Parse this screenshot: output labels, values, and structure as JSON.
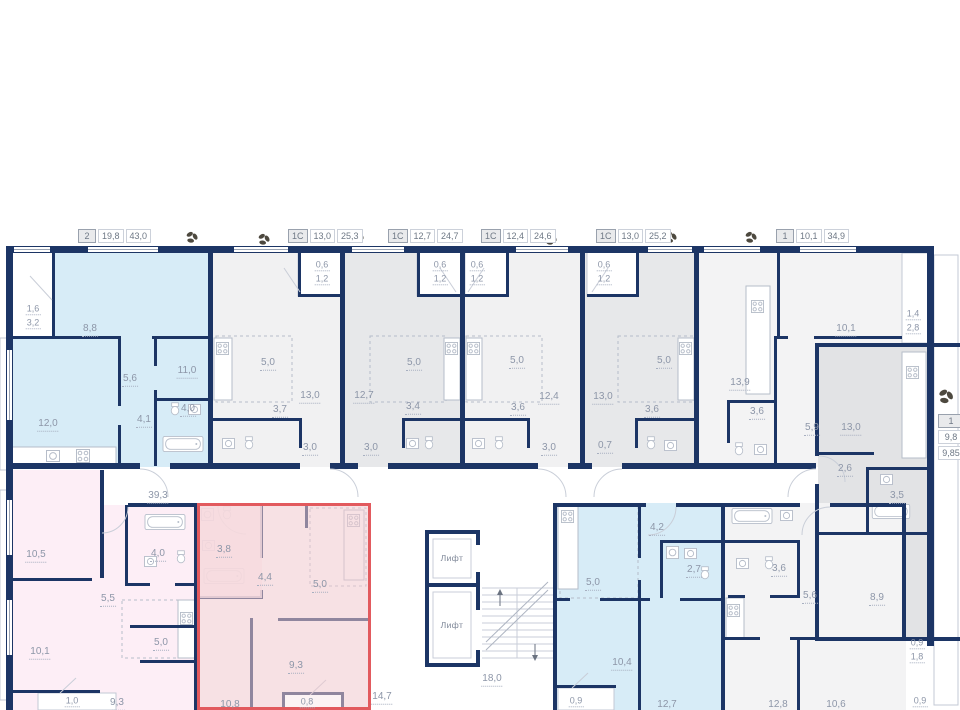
{
  "header": {
    "units": [
      {
        "type": "2",
        "kitchen_area": "19,8",
        "total_area": "43,0"
      },
      {
        "type": "1С",
        "kitchen_area": "13,0",
        "total_area": "25,3"
      },
      {
        "type": "1С",
        "kitchen_area": "12,7",
        "total_area": "24,7"
      },
      {
        "type": "1С",
        "kitchen_area": "12,4",
        "total_area": "24,6"
      },
      {
        "type": "1С",
        "kitchen_area": "13,0",
        "total_area": "25,2"
      },
      {
        "type": "1",
        "kitchen_area": "10,1",
        "total_area": "34,9"
      }
    ]
  },
  "side_label": {
    "type": "1",
    "kitchen_area": "9,8",
    "total_area": "9,85"
  },
  "elevators": {
    "label": "Лифт"
  },
  "areas": {
    "corridor": "39,3",
    "stair_hall": "18,0",
    "lift_lobby": "14,7",
    "apt_2room": {
      "balcony_reduced": "1,6",
      "balcony": "3,2",
      "bedroom": "8,8",
      "hall": "5,6",
      "room": "11,0",
      "bathroom": "4,0",
      "entry": "4,1",
      "living_kitchen": "12,0"
    },
    "studio_1": {
      "balcony_reduced": "0,6",
      "balcony": "1,2",
      "kitchen_zone": "5,0",
      "living": "13,0",
      "bathroom": "3,7",
      "entry": "3,0"
    },
    "studio_2": {
      "balcony_reduced": "0,6",
      "balcony": "1,2",
      "kitchen_zone": "5,0",
      "living": "12,7",
      "bathroom": "3,4",
      "entry": "3,0"
    },
    "studio_3": {
      "balcony_reduced": "0,6",
      "balcony": "1,2",
      "kitchen_zone": "5,0",
      "living": "12,4",
      "bathroom": "3,6",
      "entry": "3,0"
    },
    "studio_4": {
      "balcony_reduced": "0,6",
      "balcony": "1,2",
      "kitchen_zone": "5,0",
      "living": "13,0",
      "bathroom": "3,6",
      "entry": "0,7"
    },
    "apt_1room_top": {
      "living_kitchen": "13,9",
      "bathroom": "3,6",
      "room": "10,1",
      "balcony_reduced": "1,4",
      "balcony": "2,8",
      "hall": "5,9"
    },
    "apt_1room_right": {
      "living_kitchen": "13,0",
      "hall": "2,6",
      "bathroom": "3,5",
      "room": "8,9",
      "balcony_reduced": "0,9",
      "balcony": "1,8"
    },
    "apt_pink": {
      "room_1": "10,5",
      "room_2": "10,1",
      "hall": "5,5",
      "bathroom": "4,0",
      "kitchen_zone": "5,0",
      "room_3": "9,3",
      "balcony": "1,0"
    },
    "apt_selected": {
      "bathroom": "3,8",
      "hall": "4,4",
      "kitchen_zone": "5,0",
      "room_1": "9,3",
      "room_2": "10,8",
      "balcony": "0,8"
    },
    "apt_blue_bottom": {
      "kitchen_zone": "5,0",
      "hall": "4,2",
      "bathroom": "2,7",
      "room_1": "10,4",
      "room_2": "12,7",
      "balcony": "0,9"
    },
    "apt_white_bottom": {
      "bathroom": "3,6",
      "hall": "5,6",
      "room_1": "12,8",
      "room_2": "10,6",
      "balcony": "0,9"
    }
  },
  "colors": {
    "wall": "#1c3565",
    "highlight": "#e25a5e",
    "blue_unit": "#d7ecf7",
    "pink_unit": "#fdeef6",
    "selected_fill": "#f1c9ce",
    "gray_unit": "#e2e3e5",
    "fixture": "#b6bdc9",
    "label": "#8d96a8"
  }
}
